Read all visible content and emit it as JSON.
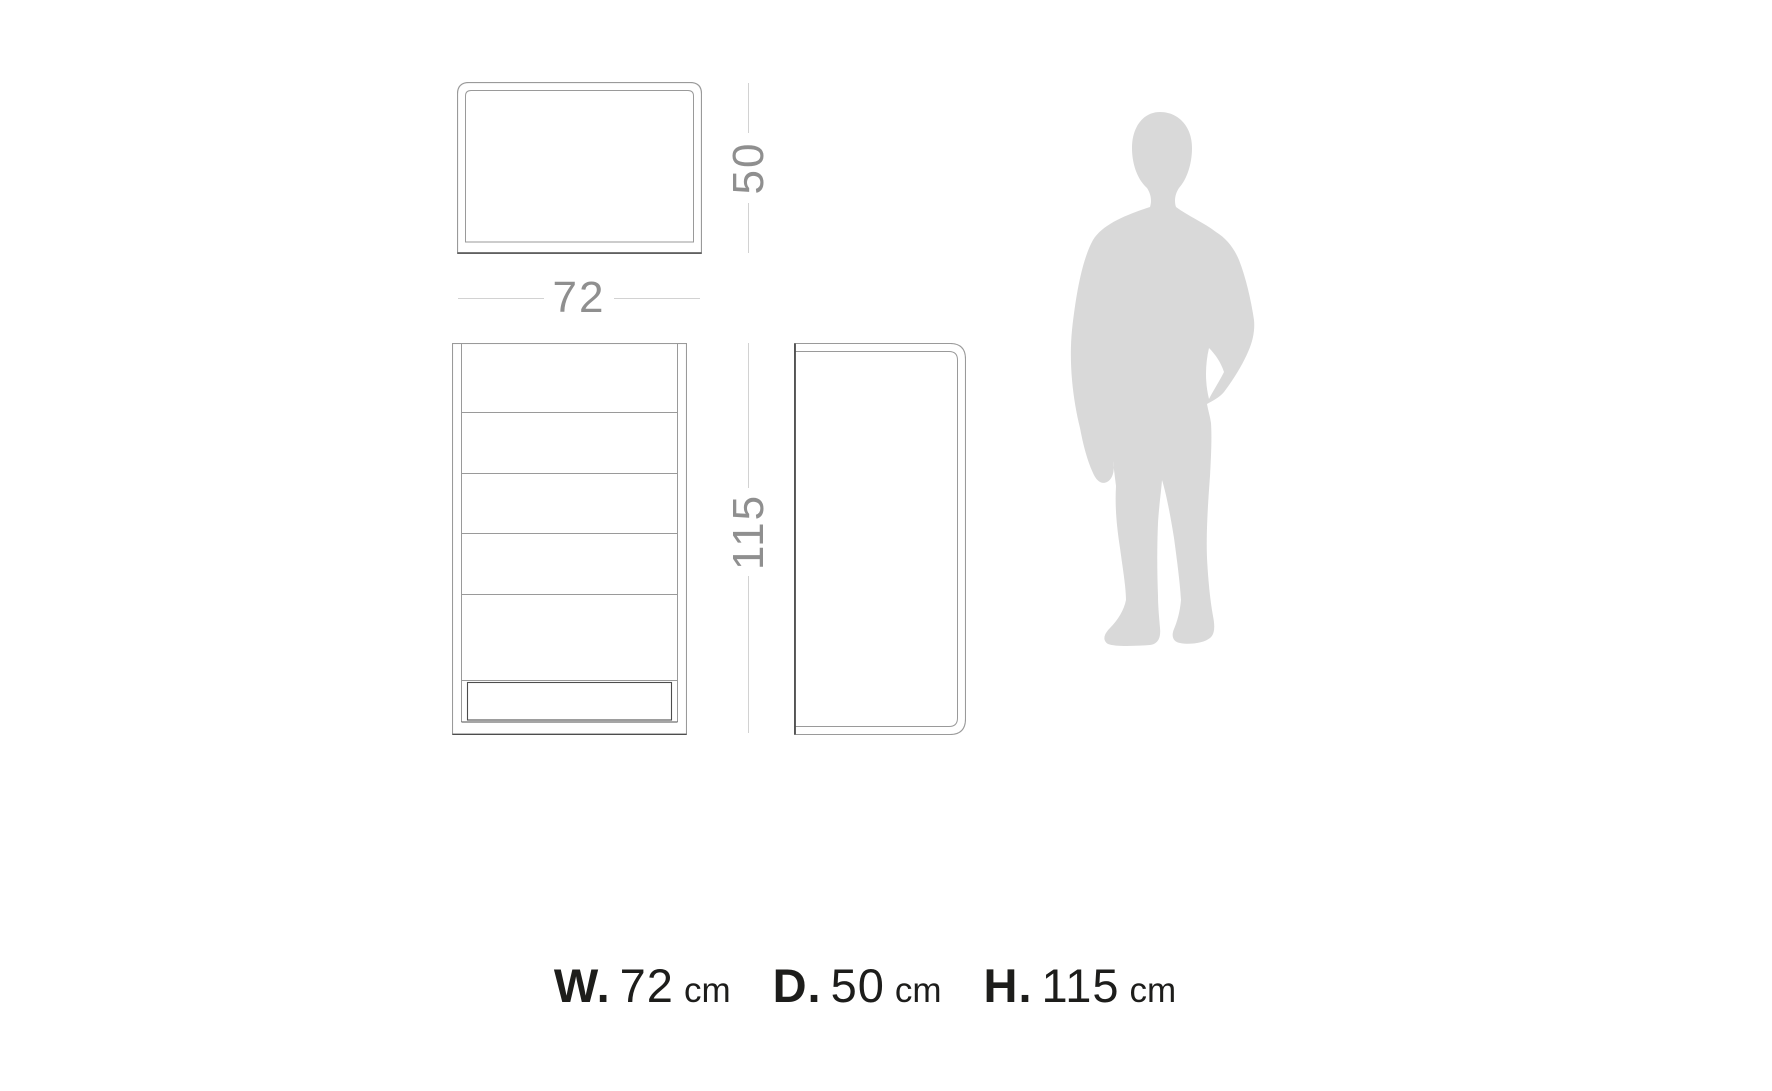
{
  "diagram": {
    "top_view": {
      "name": "top view (plan)",
      "depth_label": "50"
    },
    "front_view": {
      "name": "front view with five drawers and plinth",
      "width_label": "72",
      "height_label": "115"
    },
    "side_view": {
      "name": "side view with rounded right corners"
    },
    "scale_figure": {
      "name": "human silhouette for scale"
    },
    "caption": [
      {
        "label": "W.",
        "value": "72",
        "unit": "cm"
      },
      {
        "label": "D.",
        "value": "50",
        "unit": "cm"
      },
      {
        "label": "H.",
        "value": "115",
        "unit": "cm"
      }
    ]
  },
  "colors": {
    "background": "#ffffff",
    "line": "#9a9a9a",
    "dark_line": "#4d4d4d",
    "dim_line": "#d2d2d2",
    "dim_text": "#8f8f8f",
    "silhouette": "#d9d9d9",
    "caption_text": "#1d1d1b"
  }
}
